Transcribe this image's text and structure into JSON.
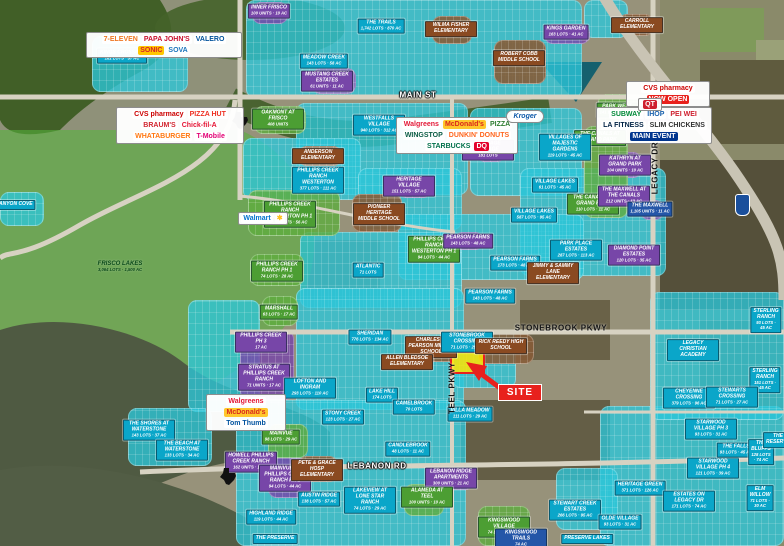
{
  "site": {
    "label": "SITE"
  },
  "colors": {
    "teal_label": "#0aa6c9",
    "purple_label": "#7746a8",
    "green_label": "#4c9e33",
    "school_label": "#8a4a21",
    "blue_label": "#2456a8",
    "site_red": "#e8211d",
    "overlay_green": "#5fac3f",
    "overlay_teal": "#2bc7da"
  },
  "streets": [
    {
      "name": "MAIN ST",
      "x": 418,
      "y": 95,
      "variant": "light",
      "vertical": false
    },
    {
      "name": "STONEBROOK PKWY",
      "x": 561,
      "y": 328,
      "variant": "dark",
      "vertical": false
    },
    {
      "name": "LEBANON RD",
      "x": 377,
      "y": 466,
      "variant": "light",
      "vertical": false
    },
    {
      "name": "TEEL PKWY",
      "x": 452,
      "y": 388,
      "variant": "dark",
      "vertical": true
    },
    {
      "name": "LEGACY DR",
      "x": 655,
      "y": 168,
      "variant": "dark",
      "vertical": true
    }
  ],
  "labels": [
    {
      "text": "KINGS CROSSING",
      "sub": "181 LOTS · 57 AC",
      "type": "teal",
      "x": 122,
      "y": 56
    },
    {
      "text": "THE TRAILS",
      "sub": "1,742 LOTS · 870 AC",
      "type": "teal",
      "x": 381,
      "y": 26
    },
    {
      "text": "MEADOW CREEK",
      "sub": "143 LOTS · 58 AC",
      "type": "teal",
      "x": 324,
      "y": 61
    },
    {
      "text": "WESTFALLS VILLAGE",
      "sub": "940 LOTS · 312 AC",
      "type": "teal",
      "x": 379,
      "y": 125
    },
    {
      "text": "KINGS GARDEN",
      "sub": "163 LOTS · 41 AC",
      "type": "purple",
      "x": 566,
      "y": 32
    },
    {
      "text": "INNER FRISCO",
      "sub": "100 UNITS · 10 AC",
      "type": "purple",
      "x": 269,
      "y": 11
    },
    {
      "text": "MUSTANG CREEK ESTATES",
      "sub": "61 UNITS · 11 AC",
      "type": "purple",
      "x": 327,
      "y": 81
    },
    {
      "text": "OAKMONT AT FRISCO",
      "sub": "408 UNITS",
      "type": "green",
      "x": 278,
      "y": 119
    },
    {
      "text": "WILMA FISHER ELEMENTARY",
      "type": "school",
      "x": 451,
      "y": 29
    },
    {
      "text": "ROBERT COBB MIDDLE SCHOOL",
      "type": "school",
      "x": 519,
      "y": 58
    },
    {
      "text": "CARROLL ELEMENTARY",
      "type": "school",
      "x": 637,
      "y": 25
    },
    {
      "text": "PARK WEST",
      "sub": "141 LOTS · 58 AC",
      "type": "green",
      "x": 617,
      "y": 110
    },
    {
      "text": "THE CARMICHAEL",
      "sub": "420 UNITS · 20 AC",
      "type": "purple",
      "x": 647,
      "y": 116
    },
    {
      "text": "THE CANALS AT GRAND PARK",
      "type": "green",
      "x": 600,
      "y": 138
    },
    {
      "text": "KATHRYN AT GRAND PARK",
      "sub": "104 UNITS · 10 AC",
      "type": "purple",
      "x": 625,
      "y": 165
    },
    {
      "text": "THE CANALS AT GRAND PARK",
      "sub": "110 LOTS · 11 AC",
      "type": "green",
      "x": 593,
      "y": 204
    },
    {
      "text": "THE MAXWELL AT THE CANALS",
      "sub": "212 UNITS · 13 AC",
      "type": "purple",
      "x": 624,
      "y": 196
    },
    {
      "text": "THE MAXWELL",
      "sub": "1,105 UNITS · 11 AC",
      "type": "blue",
      "x": 650,
      "y": 209
    },
    {
      "text": "DIAMOND POINT ESTATES",
      "sub": "120 LOTS · 35 AC",
      "type": "purple",
      "x": 634,
      "y": 255
    },
    {
      "text": "HERITAGE VILLAGE",
      "sub": "181 LOTS",
      "type": "purple",
      "x": 488,
      "y": 150
    },
    {
      "text": "HERITAGE VILLAGE",
      "sub": "151 LOTS · 57 AC",
      "type": "purple",
      "x": 409,
      "y": 186
    },
    {
      "text": "VILLAGES OF MAJESTIC GARDENS",
      "sub": "119 LOTS · 45 AC",
      "type": "teal",
      "x": 565,
      "y": 147
    },
    {
      "text": "VILLAGE LAKES",
      "sub": "61 LOTS · 45 AC",
      "type": "teal",
      "x": 555,
      "y": 185
    },
    {
      "text": "VILLAGE LAKES",
      "sub": "587 LOTS · 95 AC",
      "type": "teal",
      "x": 534,
      "y": 215
    },
    {
      "text": "ANDERSON ELEMENTARY",
      "type": "school",
      "x": 318,
      "y": 156
    },
    {
      "text": "PHILLIPS CREEK RANCH WESTERTON",
      "sub": "377 LOTS · 111 AC",
      "type": "teal",
      "x": 318,
      "y": 180
    },
    {
      "text": "PHILLIPS CREEK RANCH WESTERTON PH 1",
      "sub": "151 LOTS · 56 AC",
      "type": "green",
      "x": 290,
      "y": 214
    },
    {
      "text": "PIONEER HERITAGE MIDDLE SCHOOL",
      "type": "school",
      "x": 379,
      "y": 214
    },
    {
      "text": "PHILLIPS CREEK RANCH WESTERTON PH 1",
      "sub": "94 LOTS · 44 AC",
      "type": "green",
      "x": 434,
      "y": 249
    },
    {
      "text": "PEARSON FARMS",
      "sub": "143 LOTS · 48 AC",
      "type": "purple",
      "x": 468,
      "y": 241
    },
    {
      "text": "PEARSON FARMS",
      "sub": "173 LOTS · 48 AC",
      "type": "teal",
      "x": 515,
      "y": 263
    },
    {
      "text": "PEARSON FARMS",
      "sub": "143 LOTS · 48 AC",
      "type": "teal",
      "x": 490,
      "y": 296
    },
    {
      "text": "PARK PLACE ESTATES",
      "sub": "287 LOTS · 113 AC",
      "type": "teal",
      "x": 576,
      "y": 250
    },
    {
      "text": "JIMMY & SAMMY LANE ELEMENTARY",
      "type": "school",
      "x": 553,
      "y": 273
    },
    {
      "text": "PHILLIPS CREEK RANCH PH 1",
      "sub": "74 LOTS · 28 AC",
      "type": "green",
      "x": 277,
      "y": 271
    },
    {
      "text": "ATLANTIC",
      "sub": "71 LOTS",
      "type": "teal",
      "x": 368,
      "y": 270
    },
    {
      "text": "CANYON COVE",
      "type": "teal",
      "x": 14,
      "y": 205
    },
    {
      "text": "FRISCO LAKES",
      "sub": "3,064 LOTS · 1,500 AC",
      "type": "area",
      "x": 120,
      "y": 267
    },
    {
      "text": "MARSHALL",
      "sub": "63 LOTS · 17 AC",
      "type": "green",
      "x": 279,
      "y": 312
    },
    {
      "text": "PHILLIPS CREEK PH 3",
      "sub": "17 AC",
      "type": "purple",
      "x": 261,
      "y": 342
    },
    {
      "text": "STRATUS AT PHILLIPS CREEK RANCH",
      "sub": "71 UNITS · 17 AC",
      "type": "purple",
      "x": 264,
      "y": 377
    },
    {
      "text": "SHERIDAN",
      "sub": "776 LOTS · 134 AC",
      "type": "teal",
      "x": 370,
      "y": 337
    },
    {
      "text": "LOFTON AND INGRAM",
      "sub": "293 LOTS · 110 AC",
      "type": "teal",
      "x": 310,
      "y": 388
    },
    {
      "text": "LAKE HILL",
      "sub": "174 LOTS",
      "type": "teal",
      "x": 382,
      "y": 395
    },
    {
      "text": "STONY CREEK",
      "sub": "123 LOTS · 27 AC",
      "type": "teal",
      "x": 343,
      "y": 417
    },
    {
      "text": "CHARLES R. PEARSON MIDDLE SCHOOL",
      "type": "school",
      "x": 431,
      "y": 347
    },
    {
      "text": "STONEBROOK CROSSING",
      "sub": "71 LOTS · 25 AC",
      "type": "teal",
      "x": 467,
      "y": 342
    },
    {
      "text": "RICK REEDY HIGH SCHOOL",
      "type": "school",
      "x": 501,
      "y": 346
    },
    {
      "text": "ALLEN BLEDSOE ELEMENTARY",
      "type": "school",
      "x": 407,
      "y": 362
    },
    {
      "text": "LEGACY CHRISTIAN ACADEMY",
      "type": "teal",
      "x": 693,
      "y": 350
    },
    {
      "text": "STERLING RANCH",
      "sub": "93 LOTS · 45 AC",
      "type": "teal",
      "x": 766,
      "y": 320
    },
    {
      "text": "STERLING RANCH",
      "sub": "151 LOTS · 45 AC",
      "type": "teal",
      "x": 765,
      "y": 380
    },
    {
      "text": "CHEYENNE CROSSING",
      "sub": "379 LOTS · 96 AC",
      "type": "teal",
      "x": 689,
      "y": 398
    },
    {
      "text": "STEWARTS CROSSING",
      "sub": "71 LOTS · 27 AC",
      "type": "teal",
      "x": 732,
      "y": 397
    },
    {
      "text": "THE SHORES AT WATERSTONE",
      "sub": "143 LOTS · 37 AC",
      "type": "teal",
      "x": 149,
      "y": 430
    },
    {
      "text": "THE BEACH AT WATERSTONE",
      "sub": "133 LOTS · 34 AC",
      "type": "teal",
      "x": 182,
      "y": 450
    },
    {
      "text": "HOWELL PHILLIPS CREEK RANCH",
      "sub": "162 UNITS · 11 AC",
      "type": "purple",
      "x": 251,
      "y": 462
    },
    {
      "text": "MAINVUE",
      "sub": "98 LOTS · 29 AC",
      "type": "green",
      "x": 281,
      "y": 437
    },
    {
      "text": "MAINVUE AT PHILLIPS CREEK RANCH PH 1",
      "sub": "94 LOTS · 44 AC",
      "type": "purple",
      "x": 285,
      "y": 478
    },
    {
      "text": "PETE & GRACE HOSP ELEMENTARY",
      "type": "school",
      "x": 317,
      "y": 470
    },
    {
      "text": "AUSTIN RIDGE",
      "sub": "138 LOTS · 57 AC",
      "type": "teal",
      "x": 319,
      "y": 499
    },
    {
      "text": "LAKEVIEW AT LONE STAR RANCH",
      "sub": "74 LOTS · 29 AC",
      "type": "teal",
      "x": 370,
      "y": 500
    },
    {
      "text": "HIGHLAND RIDGE",
      "sub": "119 LOTS · 44 AC",
      "type": "teal",
      "x": 271,
      "y": 517
    },
    {
      "text": "THE PRESERVE",
      "type": "teal",
      "x": 275,
      "y": 539
    },
    {
      "text": "VILLA MEADOW",
      "sub": "111 LOTS · 29 AC",
      "type": "teal",
      "x": 470,
      "y": 414
    },
    {
      "text": "CAMELBROOK",
      "sub": "70 LOTS",
      "type": "teal",
      "x": 414,
      "y": 407
    },
    {
      "text": "CANDLEBROOK",
      "sub": "48 LOTS · 11 AC",
      "type": "teal",
      "x": 408,
      "y": 449
    },
    {
      "text": "LEBANON RIDGE APARTMENTS",
      "sub": "300 UNITS · 21 AC",
      "type": "purple",
      "x": 451,
      "y": 478
    },
    {
      "text": "ALAMEDA AT TEEL",
      "sub": "100 UNITS · 10 AC",
      "type": "green",
      "x": 427,
      "y": 497
    },
    {
      "text": "KINGSWOOD VILLAGE",
      "sub": "74 LOTS · 26 AC",
      "type": "green",
      "x": 504,
      "y": 527
    },
    {
      "text": "KINGSWOOD TRAILS",
      "sub": "74 AC",
      "type": "blue",
      "x": 521,
      "y": 539
    },
    {
      "text": "STEWART CREEK ESTATES",
      "sub": "266 LOTS · 95 AC",
      "type": "teal",
      "x": 575,
      "y": 510
    },
    {
      "text": "PRESERVE LAKES",
      "type": "teal",
      "x": 587,
      "y": 539
    },
    {
      "text": "STARWOOD VILLAGE PH 3",
      "sub": "93 LOTS · 31 AC",
      "type": "teal",
      "x": 711,
      "y": 429
    },
    {
      "text": "STARWOOD VILLAGE PH 4",
      "sub": "121 LOTS · 39 AC",
      "type": "teal",
      "x": 713,
      "y": 468
    },
    {
      "text": "THE FALLS",
      "sub": "93 LOTS · 45 AC",
      "type": "teal",
      "x": 736,
      "y": 450
    },
    {
      "text": "THE BLUFFS",
      "sub": "128 LOTS · 74 AC",
      "type": "teal",
      "x": 761,
      "y": 452
    },
    {
      "text": "THE RESERVE",
      "type": "teal",
      "x": 778,
      "y": 440
    },
    {
      "text": "HERITAGE GREEN",
      "sub": "371 LOTS · 126 AC",
      "type": "teal",
      "x": 640,
      "y": 488
    },
    {
      "text": "ESTATES ON LEGACY DR",
      "sub": "171 LOTS · 74 AC",
      "type": "teal",
      "x": 689,
      "y": 501
    },
    {
      "text": "ELM WILLOW",
      "sub": "71 LOTS · 30 AC",
      "type": "teal",
      "x": 760,
      "y": 498
    },
    {
      "text": "OLDE VILLAGE",
      "sub": "93 LOTS · 31 AC",
      "type": "teal",
      "x": 620,
      "y": 522
    }
  ],
  "logo_panels": {
    "northwest": {
      "brands": [
        {
          "name": "7-ELEVEN",
          "color": "#ee7623"
        },
        {
          "name": "PAPA JOHN'S",
          "color": "#c8102e"
        },
        {
          "name": "VALERO",
          "color": "#00529b"
        },
        {
          "name": "SONIC",
          "color": "#d3222a",
          "bg": "#ffc600"
        },
        {
          "name": "SOVA",
          "color": "#1b75bc"
        }
      ]
    },
    "west_cvs": {
      "brands": [
        {
          "name": "CVS pharmacy",
          "color": "#cc0000"
        },
        {
          "name": "PIZZA HUT",
          "color": "#ee3124"
        },
        {
          "name": "BRAUM'S",
          "color": "#d22630"
        },
        {
          "name": "Chick-fil-A",
          "color": "#e51636"
        },
        {
          "name": "WHATABURGER",
          "color": "#ff770f"
        },
        {
          "name": "T-Mobile",
          "color": "#e20074"
        }
      ]
    },
    "central": {
      "brands": [
        {
          "name": "Walgreens",
          "color": "#e31837"
        },
        {
          "name": "McDonald's",
          "color": "#da291c",
          "bg": "#ffc72c"
        },
        {
          "name": "PIZZA",
          "color": "#2e7d32"
        },
        {
          "name": "WINGSTOP",
          "color": "#0b5c44"
        },
        {
          "name": "DUNKIN' DONUTS",
          "color": "#ff671f"
        },
        {
          "name": "STARBUCKS",
          "color": "#00704a"
        },
        {
          "name": "DQ",
          "color": "#fff",
          "bg": "#e4002b"
        }
      ]
    },
    "northeast": {
      "brands": [
        {
          "name": "SUBWAY",
          "color": "#008938"
        },
        {
          "name": "IHOP",
          "color": "#1961ae"
        },
        {
          "name": "PEI WEI",
          "color": "#cf202f"
        },
        {
          "name": "LA FITNESS",
          "color": "#002244"
        },
        {
          "name": "SLIM CHICKENS",
          "color": "#333333"
        },
        {
          "name": "MAIN EVENT",
          "color": "#ffffff",
          "bg": "#00358e"
        }
      ]
    },
    "cvs_east": {
      "brands": [
        {
          "name": "CVS pharmacy",
          "color": "#cc0000"
        },
        {
          "name": "NOW OPEN",
          "color": "#ffffff",
          "bg": "#e8211d"
        }
      ]
    },
    "qt": {
      "brands": [
        {
          "name": "QT",
          "color": "#ffffff",
          "bg": "#cf202f"
        }
      ]
    },
    "walmart": {
      "brands": [
        {
          "name": "Walmart",
          "color": "#0071ce"
        },
        {
          "name": "✱",
          "color": "#ffc220"
        }
      ]
    },
    "kroger": {
      "brands": [
        {
          "name": "Kroger",
          "color": "#0b58a8"
        }
      ]
    },
    "southwest": {
      "brands": [
        {
          "name": "Walgreens",
          "color": "#e31837"
        },
        {
          "name": "McDonald's",
          "color": "#da291c",
          "bg": "#ffc72c"
        },
        {
          "name": "Tom Thumb",
          "color": "#00539f"
        }
      ]
    }
  },
  "icons": [
    {
      "name": "texas-state-icon",
      "x": 238,
      "y": 118
    },
    {
      "name": "texas-state-icon",
      "x": 226,
      "y": 474
    },
    {
      "name": "tollway-shield-icon",
      "x": 735,
      "y": 194
    },
    {
      "name": "site-arrow-icon",
      "x": 480,
      "y": 375
    }
  ]
}
